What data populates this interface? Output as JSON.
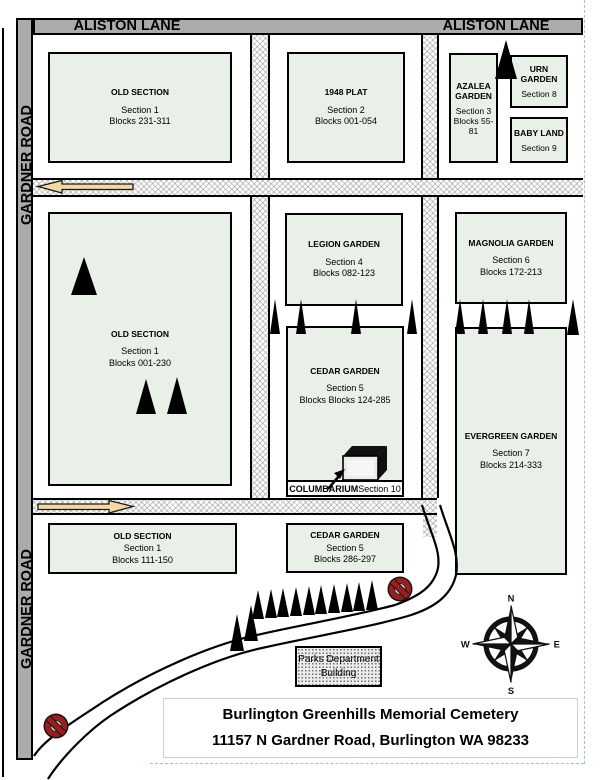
{
  "title_block": {
    "line1": "Burlington Greenhills Memorial Cemetery",
    "line2": "11157 N Gardner Road, Burlington WA 98233"
  },
  "streets": {
    "aliston_left": "ALISTON LANE",
    "aliston_right": "ALISTON LANE",
    "gardner_top": "GARDNER ROAD",
    "gardner_bottom": "GARDNER ROAD"
  },
  "sections": {
    "old_top": {
      "title": "OLD SECTION",
      "line1": "Section 1",
      "line2": "Blocks 231-311"
    },
    "plat_1948": {
      "title": "1948 PLAT",
      "line1": "Section 2",
      "line2": "Blocks 001-054"
    },
    "azalea": {
      "title": "AZALEA GARDEN",
      "line1": "Section 3",
      "line2": "Blocks 55-81"
    },
    "urn": {
      "title": "URN GARDEN",
      "line1": "Section 8"
    },
    "baby_land": {
      "title": "BABY LAND",
      "line1": "Section 9"
    },
    "old_main": {
      "title": "OLD SECTION",
      "line1": "Section 1",
      "line2": "Blocks 001-230"
    },
    "legion": {
      "title": "LEGION GARDEN",
      "line1": "Section 4",
      "line2": "Blocks 082-123"
    },
    "magnolia": {
      "title": "MAGNOLIA GARDEN",
      "line1": "Section 6",
      "line2": "Blocks 172-213"
    },
    "cedar_main": {
      "title": "CEDAR GARDEN",
      "line1": "Section 5",
      "line2": "Blocks Blocks 124-285"
    },
    "evergreen": {
      "title": "EVERGREEN GARDEN",
      "line1": "Section 7",
      "line2": "Blocks 214-333"
    },
    "old_bottom": {
      "title": "OLD SECTION",
      "line1": "Section 1",
      "line2": "Blocks 111-150"
    },
    "cedar_bottom": {
      "title": "CEDAR GARDEN",
      "line1": "Section 5",
      "line2": "Blocks 286-297"
    }
  },
  "columbarium": {
    "label_bold": "COLUMBARIUM",
    "label_rest": " Section 10"
  },
  "buildings": {
    "parks_line1": "Parks Department",
    "parks_line2": "Building"
  },
  "compass": {
    "n": "N",
    "e": "E",
    "s": "S",
    "w": "W"
  },
  "colors": {
    "section_fill": "#e9f0e8",
    "street_bar": "#ababab",
    "arrow_fill": "#f1d9a0",
    "no_entry_red": "#9d1c1c"
  },
  "trees": [
    [
      506,
      37,
      22,
      39
    ],
    [
      84,
      254,
      26,
      38
    ],
    [
      146,
      376,
      20,
      35
    ],
    [
      177,
      374,
      20,
      37
    ],
    [
      275,
      296,
      11,
      35
    ],
    [
      301,
      296,
      11,
      35
    ],
    [
      356,
      296,
      11,
      35
    ],
    [
      412,
      296,
      11,
      35
    ],
    [
      460,
      296,
      11,
      35
    ],
    [
      483,
      296,
      11,
      35
    ],
    [
      507,
      296,
      11,
      35
    ],
    [
      529,
      296,
      11,
      35
    ],
    [
      573,
      296,
      12,
      36
    ],
    [
      237,
      611,
      15,
      37
    ],
    [
      251,
      602,
      14,
      36
    ],
    [
      258,
      587,
      13,
      29
    ],
    [
      271,
      586,
      13,
      29
    ],
    [
      283,
      585,
      13,
      29
    ],
    [
      296,
      584,
      13,
      29
    ],
    [
      309,
      583,
      13,
      29
    ],
    [
      321,
      582,
      13,
      29
    ],
    [
      334,
      581,
      13,
      29
    ],
    [
      347,
      580,
      13,
      29
    ],
    [
      359,
      579,
      13,
      29
    ],
    [
      372,
      577,
      13,
      30
    ]
  ]
}
